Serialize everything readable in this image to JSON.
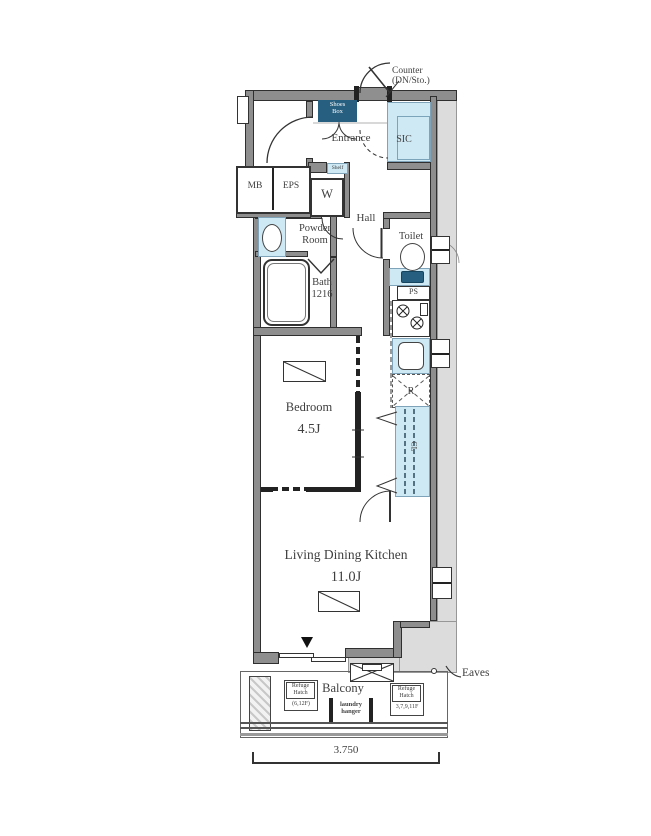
{
  "colors": {
    "light_blue": "#cfe9f4",
    "dark_blue": "#275f80",
    "wall_gray": "#8e8e8e",
    "eaves_gray": "#dcdcdc",
    "line": "#333333",
    "text": "#3f3f3f"
  },
  "labels": {
    "counter1": "Counter",
    "counter2": "(DN/Sto.)",
    "shoes1": "Shoes",
    "shoes2": "Box",
    "entrance": "Entrance",
    "sic": "SIC",
    "shelf": "Shelf",
    "mb": "MB",
    "eps": "EPS",
    "washer": "W",
    "hall": "Hall",
    "powder1": "Powder",
    "powder2": "Room",
    "toilet": "Toilet",
    "bath1": "Bath",
    "bath2": "1216",
    "ps": "PS",
    "fridge": "R",
    "closet": "CL",
    "bedroom": "Bedroom",
    "bedroom_size": "4.5J",
    "ldk": "Living Dining Kitchen",
    "ldk_size": "11.0J",
    "balcony": "Balcony",
    "laundry1": "laundry",
    "laundry2": "hanger",
    "refuge_l1": "Refuge",
    "refuge_l2": "Hatch",
    "refuge_l3": "(6,12F)",
    "refuge_r1": "Refuge",
    "refuge_r2": "Hatch",
    "refuge_r3": "3,7,9,11F",
    "eaves": "Eaves",
    "dim_width": "3.750"
  }
}
